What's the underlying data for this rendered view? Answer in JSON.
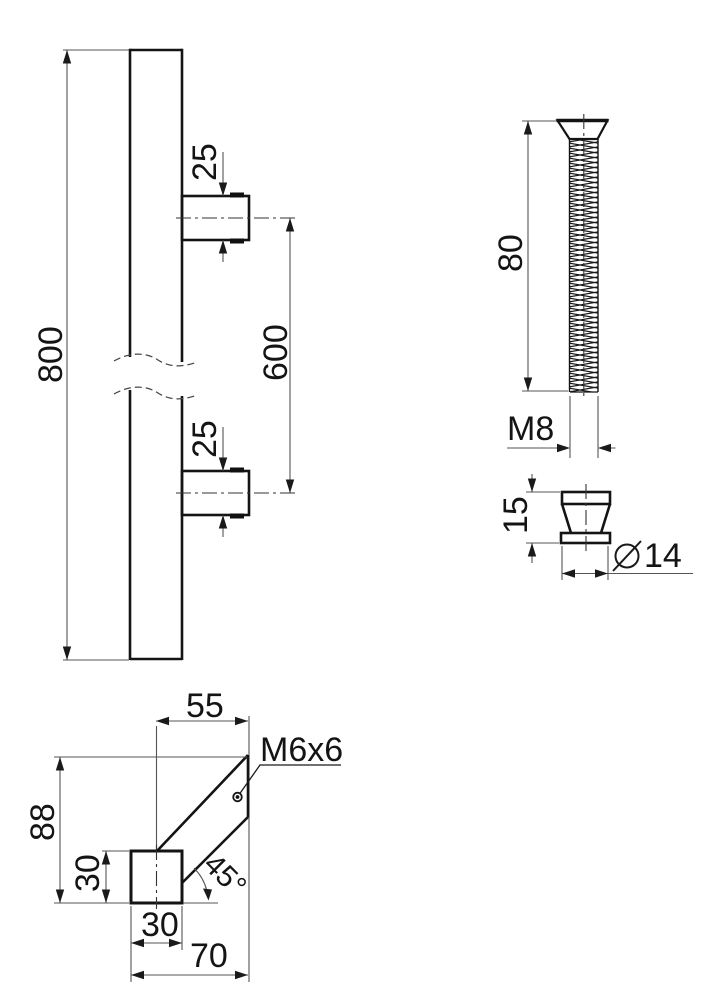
{
  "labels": {
    "handle": {
      "length": "800",
      "stud_top": "25",
      "stud_bottom": "25",
      "spacing": "600"
    },
    "screw": {
      "length": "80",
      "thread": "M8"
    },
    "cap": {
      "height": "15",
      "diameter": "14"
    },
    "bracket": {
      "width_top": "55",
      "set_screw": "M6x6",
      "height": "88",
      "block_height": "30",
      "block_width": "30",
      "width_total": "70",
      "angle": "45°"
    }
  },
  "colors": {
    "object_line": "#141414",
    "dimension_line": "#555555",
    "text": "#141414",
    "background": "#ffffff"
  }
}
